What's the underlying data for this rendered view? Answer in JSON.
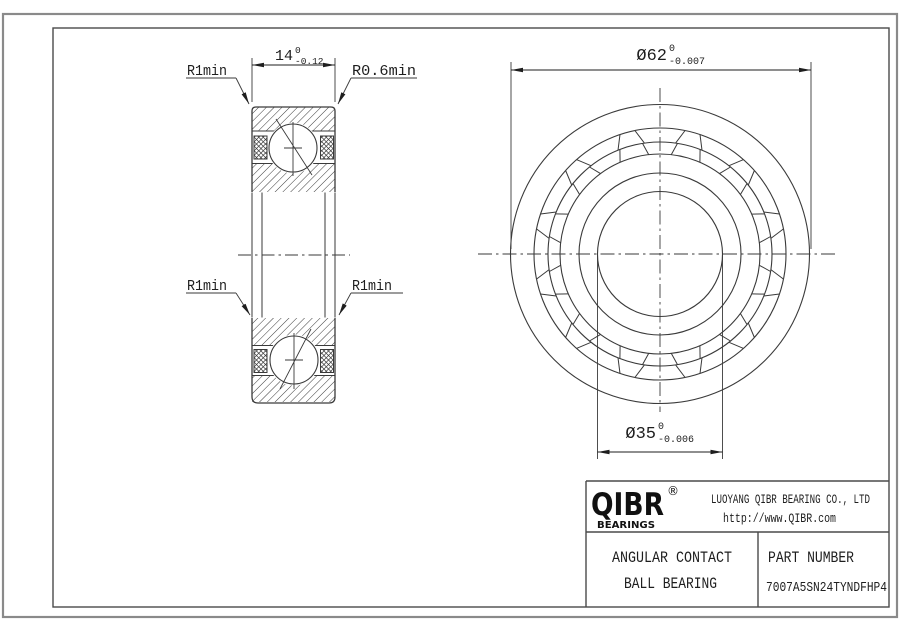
{
  "section_view": {
    "width_dim": {
      "value": "14",
      "tol_upper": "0",
      "tol_lower": "-0.12"
    },
    "labels": {
      "top_left": "R1min",
      "top_right": "R0.6min",
      "bottom_left": "R1min",
      "bottom_right": "R1min"
    }
  },
  "front_view": {
    "ball_pocket_count": 12,
    "od_dim": {
      "value": "Ø62",
      "tol_upper": "0",
      "tol_lower": "-0.007"
    },
    "bore_dim": {
      "value": "Ø35",
      "tol_upper": "0",
      "tol_lower": "-0.006"
    }
  },
  "title_block": {
    "logo_text": "QIBR",
    "logo_reg": "®",
    "logo_sub": "BEARINGS",
    "company": "LUOYANG QIBR BEARING CO., LTD",
    "website": "http://www.QIBR.com",
    "product_line1": "ANGULAR CONTACT",
    "product_line2": "BALL BEARING",
    "part_number_label": "PART NUMBER",
    "part_number": "7007A5SN24TYNDFHP4"
  },
  "colors": {
    "line": "#3a3a3a",
    "frame_outer": "#8a8a8a",
    "frame_inner": "#4a4a4a",
    "text": "#1e1e1e",
    "background": "#ffffff"
  }
}
